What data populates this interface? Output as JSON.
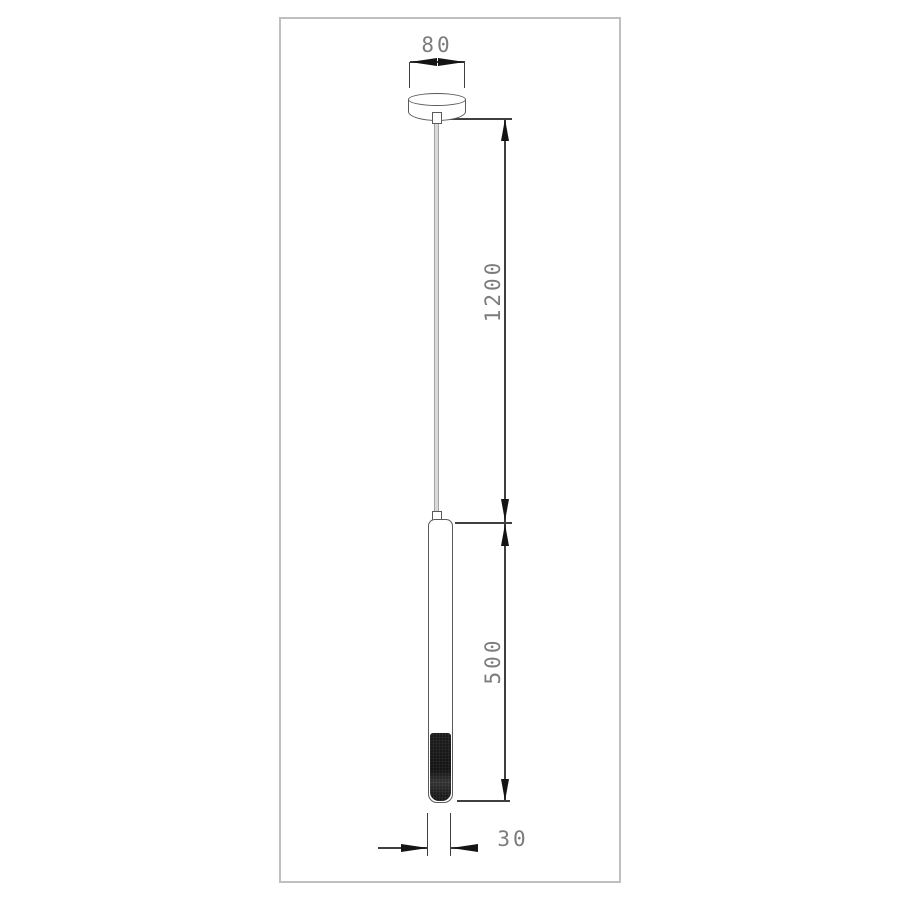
{
  "drawing": {
    "type": "technical-dimension-drawing",
    "subject": "pendant-lamp",
    "dimensions": {
      "canopy_width": "80",
      "suspension_drop": "1200",
      "body_length": "500",
      "body_diameter": "30"
    },
    "colors": {
      "background": "#ffffff",
      "frame_border": "#bfbfbf",
      "dimension_line": "#3f3f3f",
      "arrow_fill": "#141414",
      "dimension_text": "#7c7c7c",
      "object_outline": "#5a5a5a",
      "cable_fill": "#dadada",
      "cable_edge": "#a3a3a3",
      "cap_fill": "#1a1a1a"
    }
  }
}
